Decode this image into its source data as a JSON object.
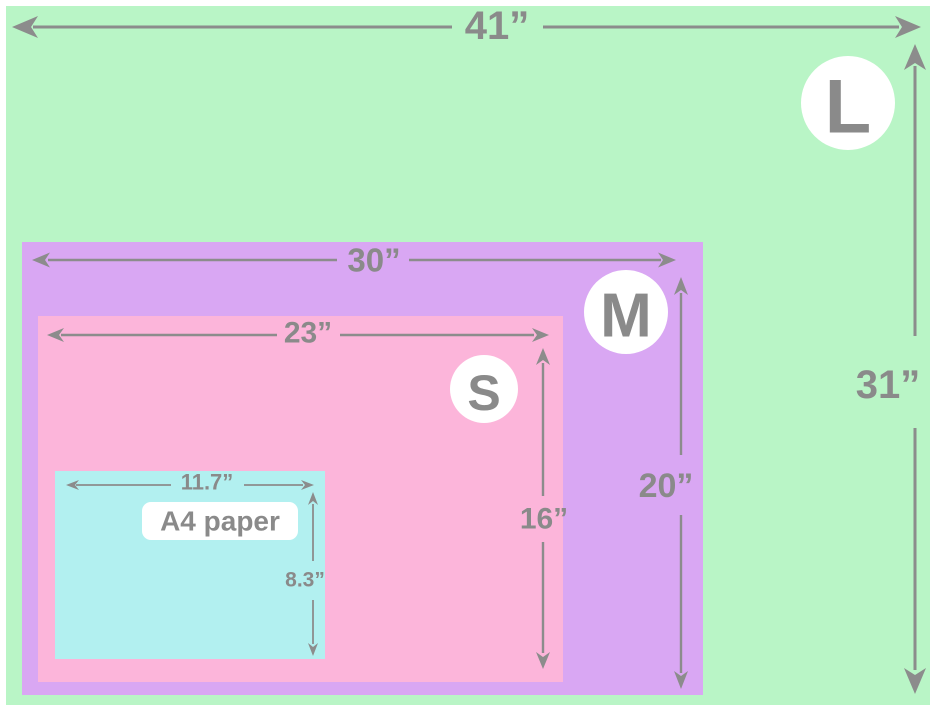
{
  "colors": {
    "page_bg": "#ffffff",
    "dim_line": "#8c8c8c",
    "dim_text": "#8a8a8a",
    "badge_bg": "#ffffff",
    "a4_label_bg": "#ffffff"
  },
  "diagram": {
    "sizes": {
      "L": {
        "badge": "L",
        "width": "41”",
        "height": "31”",
        "color": "#b9f5c6"
      },
      "M": {
        "badge": "M",
        "width": "30”",
        "height": "20”",
        "color": "#d9a7f3"
      },
      "S": {
        "badge": "S",
        "width": "23”",
        "height": "16”",
        "color": "#fcb5da"
      },
      "A4": {
        "label": "A4 paper",
        "width": "11.7”",
        "height": "8.3”",
        "color": "#b2f0f0"
      }
    }
  }
}
